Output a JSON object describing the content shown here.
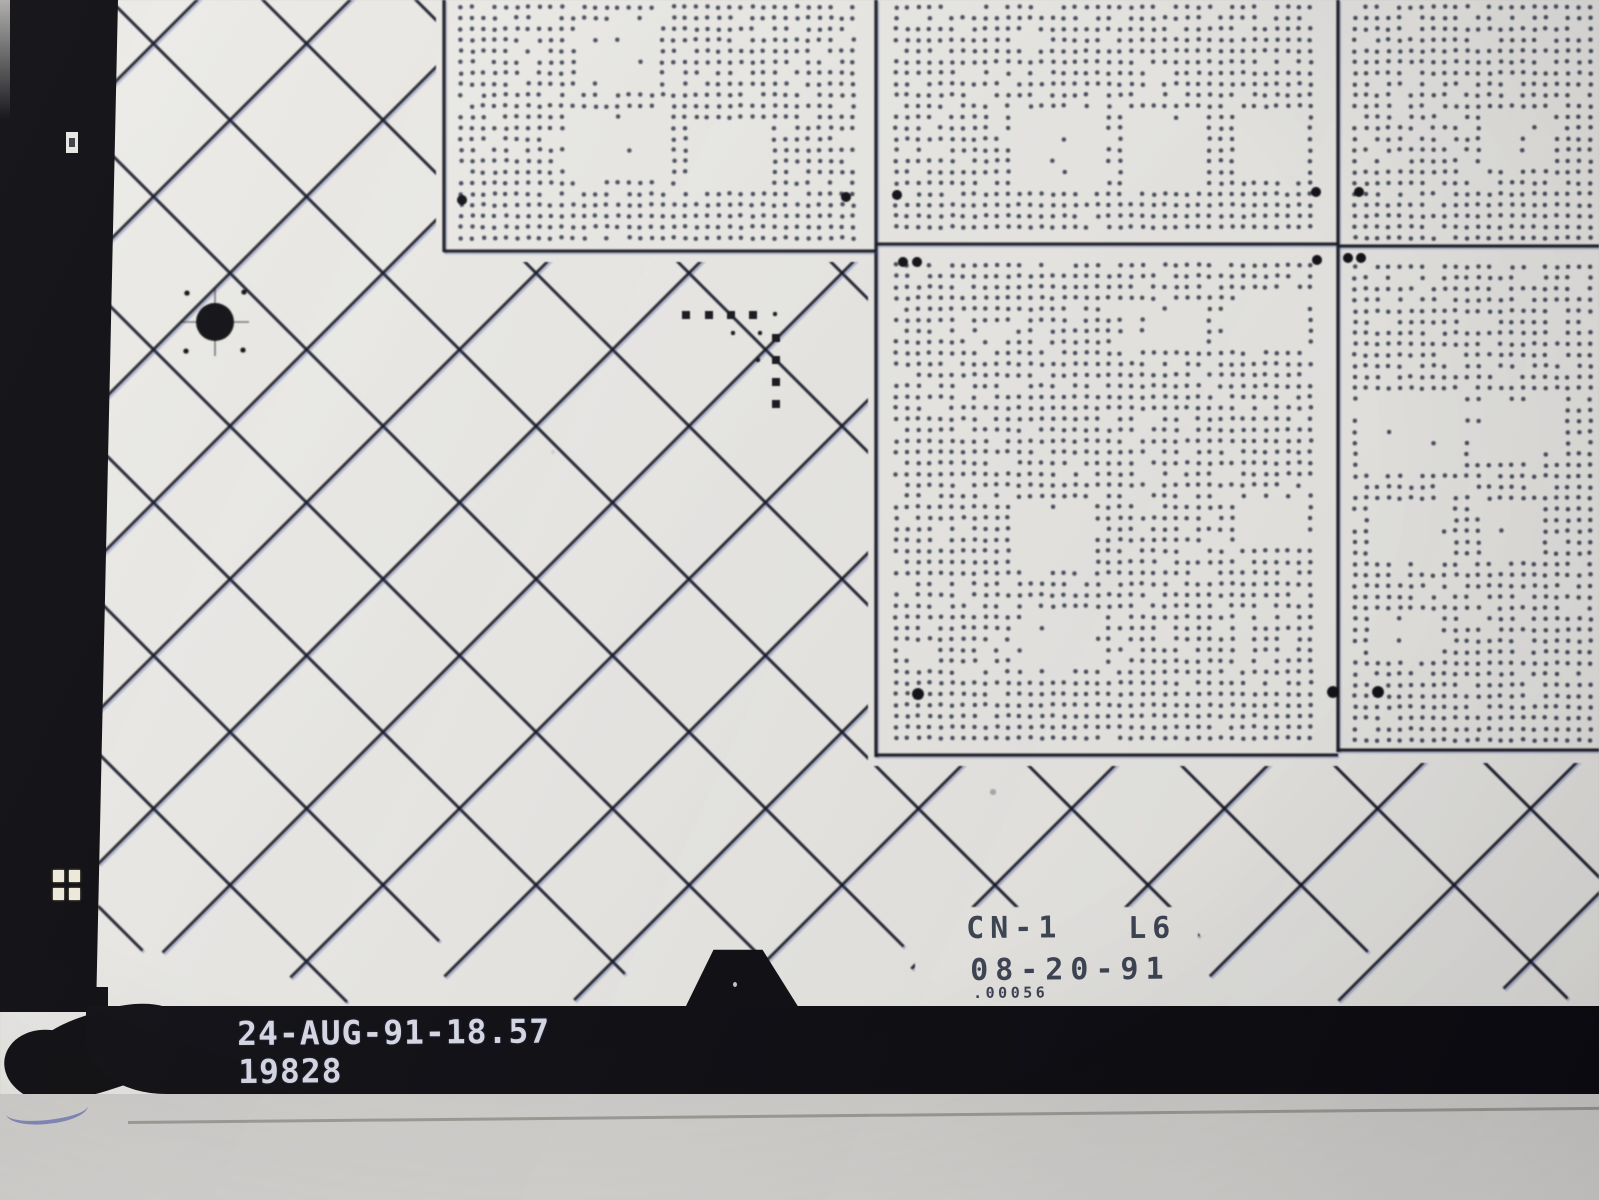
{
  "scene": {
    "description": "photograph of a chrome-on-glass photolithography mask plate on a light table; halftone-dot die arrays, diagonal scribe crosshatch, alignment fiducials, etched lot labels and a black edge strip with exposure stamp"
  },
  "labels": {
    "mask_line1_left": "CN-1",
    "mask_line1_right": "L6",
    "mask_line2": "08-20-91",
    "mask_line3": ".00056",
    "bar_line1": "24-AUG-91-18.57",
    "bar_line2": "19828"
  },
  "colors": {
    "plate_light": "#edecE8",
    "plate_dark": "#e1e0dd",
    "hatch_line": "rgba(18,18,26,0.92)",
    "hatch_fringe": "rgba(45,65,165,0.28)",
    "dot": "rgba(52,58,74,0.9)",
    "border_line": "#16161e",
    "fiducial": "#0e0e14",
    "bar": "#0b0b10",
    "etched_text": "#3b4251",
    "stamp_text": "#d7d8e4"
  },
  "render": {
    "hatch": {
      "spacing": 153,
      "cModA": 43,
      "cModB": 44,
      "xMin": 98,
      "xMax": 1640,
      "yTop": -70,
      "yEndMin": 935,
      "yEndMax": 1005,
      "clearRect": [
        915,
        907,
        283,
        99
      ]
    },
    "slabs": [
      [
        436,
        0,
        446,
        262
      ],
      [
        868,
        0,
        478,
        766
      ],
      [
        1330,
        0,
        270,
        763
      ]
    ],
    "borders": [
      [
        444,
        0,
        444,
        252
      ],
      [
        876,
        0,
        876,
        757
      ],
      [
        1338,
        0,
        1338,
        752
      ],
      [
        444,
        251,
        876,
        251
      ],
      [
        876,
        244,
        1338,
        244
      ],
      [
        1338,
        246,
        1599,
        246
      ],
      [
        876,
        755,
        1338,
        755
      ],
      [
        1338,
        750,
        1599,
        750
      ]
    ],
    "blocks": [
      {
        "seed": 11,
        "x0": 458,
        "y0": 4,
        "x1": 862,
        "y1": 246,
        "band": [
          198,
          242
        ],
        "rows": [
          [
            4,
            102
          ],
          [
            102,
            196
          ]
        ]
      },
      {
        "seed": 22,
        "x0": 893,
        "y0": 4,
        "x1": 1322,
        "y1": 240,
        "band": [
          195,
          238
        ],
        "rows": [
          [
            4,
            100
          ],
          [
            100,
            194
          ]
        ]
      },
      {
        "seed": 33,
        "x0": 1352,
        "y0": 4,
        "x1": 1596,
        "y1": 242,
        "band": [
          196,
          240
        ],
        "rows": [
          [
            4,
            100
          ],
          [
            100,
            195
          ]
        ]
      },
      {
        "seed": 44,
        "x0": 893,
        "y0": 262,
        "x1": 1322,
        "y1": 752,
        "band": [
          690,
          748
        ],
        "rows": [
          [
            268,
            372
          ],
          [
            372,
            476
          ],
          [
            476,
            580
          ],
          [
            580,
            686
          ]
        ]
      },
      {
        "seed": 55,
        "x0": 1352,
        "y0": 264,
        "x1": 1596,
        "y1": 748,
        "band": [
          688,
          744
        ],
        "rows": [
          [
            270,
            374
          ],
          [
            374,
            478
          ],
          [
            478,
            582
          ],
          [
            582,
            686
          ]
        ]
      }
    ],
    "dotPitch": 11.2,
    "dotR": 2.25,
    "fiducials": [
      [
        462,
        200,
        5
      ],
      [
        846,
        197,
        5
      ],
      [
        897,
        195,
        5
      ],
      [
        1316,
        192,
        5
      ],
      [
        1359,
        192,
        5
      ],
      [
        903,
        262,
        5
      ],
      [
        917,
        262,
        5
      ],
      [
        1317,
        260,
        5
      ],
      [
        918,
        694,
        6
      ],
      [
        1333,
        692,
        6
      ],
      [
        1348,
        258,
        5
      ],
      [
        1361,
        258,
        5
      ],
      [
        1378,
        692,
        6
      ]
    ],
    "blob": {
      "cx": 215,
      "cy": 322,
      "r": 19,
      "sat": [
        [
          187,
          293
        ],
        [
          244,
          292
        ],
        [
          186,
          351
        ],
        [
          243,
          350
        ]
      ],
      "satR": 2.6,
      "tick": 34
    },
    "lmark": {
      "sq": 8,
      "row_y": 315,
      "row_x": [
        686,
        709,
        731,
        753
      ],
      "col_x": 776,
      "col_y": [
        338,
        360,
        382,
        404
      ],
      "dots": [
        [
          775,
          314
        ],
        [
          733,
          333
        ],
        [
          760,
          333
        ],
        [
          758,
          360
        ]
      ],
      "dotR": 2.2
    },
    "specks": [
      [
        993,
        792,
        3,
        0.5
      ],
      [
        1437,
        1147,
        2,
        0.25
      ],
      [
        553,
        452,
        2,
        0.18
      ]
    ]
  }
}
